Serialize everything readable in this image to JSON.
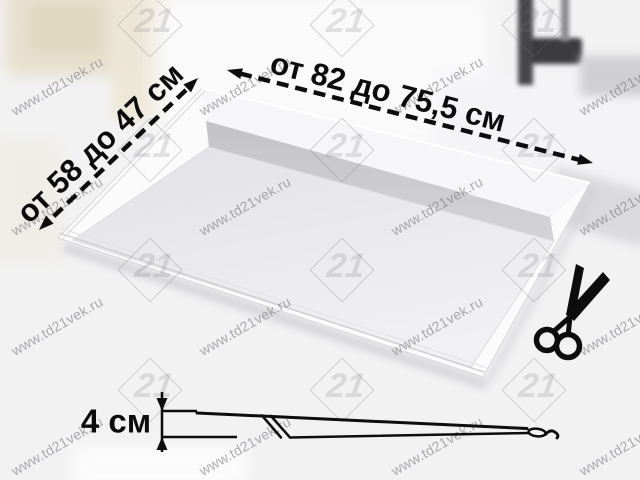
{
  "product": {
    "width_dimension": "от 82 до 75,5 см",
    "depth_dimension": "от 58 до 47 см",
    "height_dimension": "4 см"
  },
  "watermark": {
    "site_text": "www.td21vek.ru",
    "logo_number": "21"
  },
  "icons": {
    "scissors": "scissors-icon"
  },
  "colors": {
    "annotation_black": "#0d0d0d",
    "watermark_gray": "#8a8a8c",
    "tray_wall_gray": "#c9c9cd",
    "tray_floor_light": "#ededf0",
    "background": "#f2f2f3"
  }
}
